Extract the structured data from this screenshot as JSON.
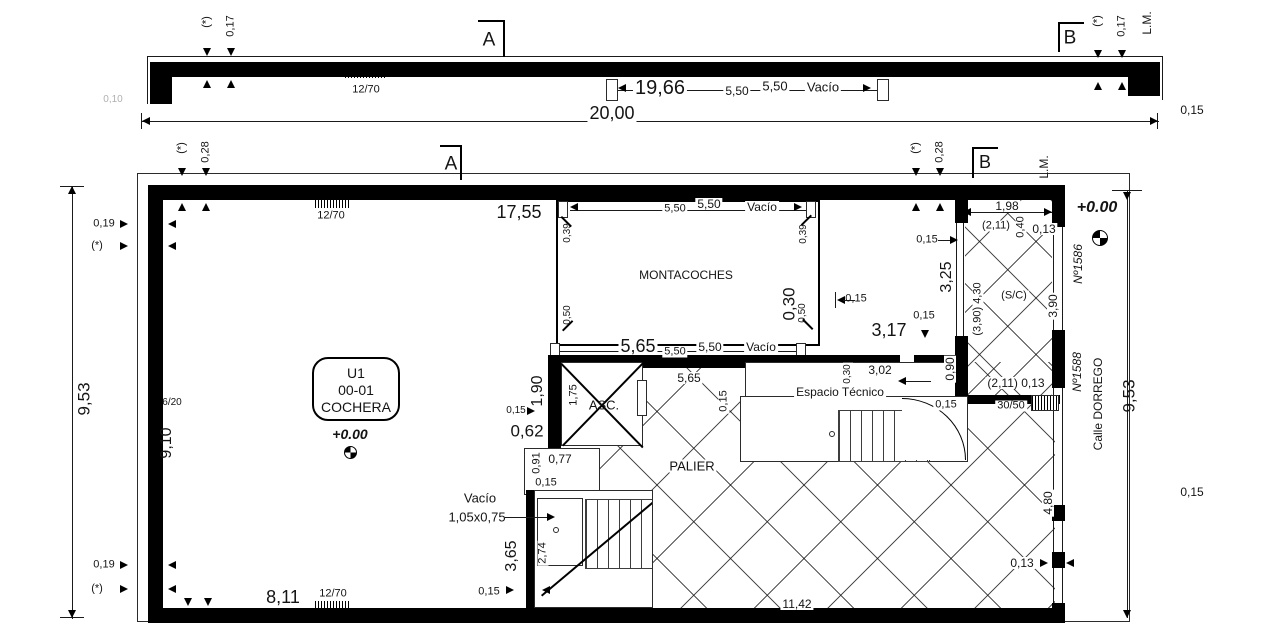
{
  "drawing": {
    "type": "architectural-floor-plan",
    "unit_label": "U1 00-01 COCHERA",
    "street": "Calle DORREGO",
    "colors": {
      "ink": "#141414",
      "wall": "#000000",
      "paper": "#ffffff",
      "faint": "#b0b0b0"
    }
  },
  "labels": [
    {
      "id": "star-top-left",
      "t": "(*)",
      "x": 207,
      "y": 22,
      "r": -90
    },
    {
      "id": "dim-017-left",
      "t": "0,17",
      "x": 231,
      "y": 26,
      "r": -90
    },
    {
      "id": "hatch-1270-topstrip",
      "t": "12/70",
      "x": 366,
      "y": 90
    },
    {
      "id": "marker-a-topstrip",
      "t": "A",
      "x": 489,
      "y": 40,
      "s": 19
    },
    {
      "id": "dim-1966",
      "t": "19,66",
      "x": 660,
      "y": 88,
      "s": 20,
      "bg": 1
    },
    {
      "id": "dim-550a-topstrip",
      "t": "5,50",
      "x": 737,
      "y": 91,
      "s": 12,
      "bg": 1
    },
    {
      "id": "dim-550b-topstrip",
      "t": "5,50",
      "x": 775,
      "y": 86,
      "s": 13,
      "bg": 1
    },
    {
      "id": "vacio-topstrip",
      "t": "Vacío",
      "x": 823,
      "y": 87,
      "s": 13,
      "bg": 1
    },
    {
      "id": "marker-b-topstrip",
      "t": "B",
      "x": 1070,
      "y": 38,
      "s": 19
    },
    {
      "id": "star-top-right",
      "t": "(*)",
      "x": 1098,
      "y": 21,
      "r": -90
    },
    {
      "id": "dim-017-right",
      "t": "0,17",
      "x": 1122,
      "y": 26,
      "r": -90
    },
    {
      "id": "lm-topstrip",
      "t": "L.M.",
      "x": 1147,
      "y": 23,
      "r": -90,
      "s": 12
    },
    {
      "id": "dim-015-topright",
      "t": "0,15",
      "x": 1192,
      "y": 110,
      "s": 12
    },
    {
      "id": "dim-2000",
      "t": "20,00",
      "x": 612,
      "y": 113,
      "s": 18,
      "bg": 1
    },
    {
      "id": "faint-010",
      "t": "0,10",
      "x": 113,
      "y": 100,
      "s": 10,
      "c": "#b0b0b0"
    },
    {
      "id": "star-main-left",
      "t": "(*)",
      "x": 182,
      "y": 148,
      "r": -90
    },
    {
      "id": "dim-028-left",
      "t": "0,28",
      "x": 206,
      "y": 152,
      "r": -90
    },
    {
      "id": "marker-a-main",
      "t": "A",
      "x": 451,
      "y": 164,
      "s": 19
    },
    {
      "id": "hatch-1270-main",
      "t": "12/70",
      "x": 331,
      "y": 216
    },
    {
      "id": "dim-1755",
      "t": "17,55",
      "x": 519,
      "y": 212,
      "s": 18
    },
    {
      "id": "dim-550a-mont-top",
      "t": "5,50",
      "x": 675,
      "y": 209,
      "bg": 1
    },
    {
      "id": "dim-550b-mont-top",
      "t": "5,50",
      "x": 709,
      "y": 204,
      "s": 12,
      "bg": 1
    },
    {
      "id": "vacio-mont-top",
      "t": "Vacío",
      "x": 762,
      "y": 207,
      "s": 12,
      "bg": 1
    },
    {
      "id": "star-main-right",
      "t": "(*)",
      "x": 916,
      "y": 148,
      "r": -90
    },
    {
      "id": "dim-028-right",
      "t": "0,28",
      "x": 940,
      "y": 152,
      "r": -90
    },
    {
      "id": "marker-b-main",
      "t": "B",
      "x": 985,
      "y": 162,
      "s": 18
    },
    {
      "id": "lm-main",
      "t": "L.M.",
      "x": 1044,
      "y": 167,
      "r": -90,
      "s": 12
    },
    {
      "id": "dim-198",
      "t": "1,98",
      "x": 1007,
      "y": 206,
      "s": 12,
      "bg": 1
    },
    {
      "id": "dim-211-top",
      "t": "(2,11)",
      "x": 996,
      "y": 226,
      "bg": 1
    },
    {
      "id": "dim-040",
      "t": "0,40",
      "x": 1021,
      "y": 227,
      "r": -90,
      "bg": 1
    },
    {
      "id": "dim-013-top",
      "t": "0,13",
      "x": 1044,
      "y": 229,
      "s": 12,
      "bg": 1
    },
    {
      "id": "level-main",
      "t": "+0.00",
      "x": 1097,
      "y": 208,
      "s": 16,
      "i": 1,
      "b": 1
    },
    {
      "id": "no-1586",
      "t": "Nº1586",
      "x": 1078,
      "y": 264,
      "r": -90,
      "s": 12,
      "i": 1
    },
    {
      "id": "dim-015-entry-top",
      "t": "0,15",
      "x": 927,
      "y": 240
    },
    {
      "id": "dim-325",
      "t": "3,25",
      "x": 947,
      "y": 277,
      "r": -90,
      "s": 16
    },
    {
      "id": "dim-390-430",
      "t": "(3,90) 4,30",
      "x": 978,
      "y": 309,
      "r": -90,
      "bg": 1
    },
    {
      "id": "sc-label",
      "t": "(S/C)",
      "x": 1014,
      "y": 296,
      "bg": 1
    },
    {
      "id": "dim-390-right",
      "t": "3,90",
      "x": 1053,
      "y": 306,
      "r": -90,
      "s": 12,
      "bg": 1
    },
    {
      "id": "dim-015-entry-mid",
      "t": "0,15",
      "x": 924,
      "y": 316,
      "bg": 1
    },
    {
      "id": "dim-090",
      "t": "0,90",
      "x": 950,
      "y": 369,
      "r": -90,
      "s": 12,
      "bg": 1
    },
    {
      "id": "dim-211-bottom",
      "t": "(2,11) 0,13",
      "x": 1016,
      "y": 383,
      "s": 12,
      "bg": 1
    },
    {
      "id": "hatch-3050",
      "t": "30/50",
      "x": 1011,
      "y": 406,
      "bg": 1
    },
    {
      "id": "no-1588",
      "t": "Nº1588",
      "x": 1077,
      "y": 372,
      "r": -90,
      "s": 12,
      "i": 1
    },
    {
      "id": "calle-dorrego",
      "t": "Calle DORREGO",
      "x": 1098,
      "y": 404,
      "r": -90,
      "s": 12
    },
    {
      "id": "dim-953-right",
      "t": "9,53",
      "x": 1129,
      "y": 396,
      "r": -90,
      "s": 17
    },
    {
      "id": "dim-015-right",
      "t": "0,15",
      "x": 1192,
      "y": 492,
      "s": 12
    },
    {
      "id": "dim-480",
      "t": "4,80",
      "x": 1048,
      "y": 503,
      "r": -90,
      "s": 12,
      "bg": 1
    },
    {
      "id": "dim-013-bottom",
      "t": "0,13",
      "x": 1022,
      "y": 563,
      "s": 12,
      "bg": 1
    },
    {
      "id": "dim-039-left",
      "t": "0,39",
      "x": 568,
      "y": 233,
      "r": -90,
      "s": 10
    },
    {
      "id": "dim-039-right",
      "t": "0,39",
      "x": 804,
      "y": 234,
      "r": -90,
      "s": 10
    },
    {
      "id": "montacoches",
      "t": "MONTACOCHES",
      "x": 686,
      "y": 275,
      "s": 12
    },
    {
      "id": "dim-050-left",
      "t": "0,50",
      "x": 568,
      "y": 315,
      "r": -90,
      "s": 10
    },
    {
      "id": "dim-030-big",
      "t": "0,30",
      "x": 789,
      "y": 304,
      "r": -90,
      "s": 17
    },
    {
      "id": "dim-050-right",
      "t": "0,50",
      "x": 803,
      "y": 313,
      "r": -90,
      "s": 10
    },
    {
      "id": "dim-015-mont",
      "t": "0,15",
      "x": 856,
      "y": 299
    },
    {
      "id": "dim-565-big",
      "t": "5,65",
      "x": 638,
      "y": 346,
      "s": 18,
      "bg": 1
    },
    {
      "id": "dim-550a-mont-bot",
      "t": "5,50",
      "x": 675,
      "y": 352,
      "bg": 1
    },
    {
      "id": "dim-550b-mont-bot",
      "t": "5,50",
      "x": 710,
      "y": 347,
      "s": 12,
      "bg": 1
    },
    {
      "id": "vacio-mont-bot",
      "t": "Vacío",
      "x": 761,
      "y": 347,
      "s": 12,
      "bg": 1
    },
    {
      "id": "dim-317",
      "t": "3,17",
      "x": 889,
      "y": 330,
      "s": 18
    },
    {
      "id": "dim-190",
      "t": "1,90",
      "x": 538,
      "y": 391,
      "r": -90,
      "s": 16
    },
    {
      "id": "dim-175",
      "t": "1,75",
      "x": 574,
      "y": 395,
      "r": -90
    },
    {
      "id": "asc",
      "t": "ASC.",
      "x": 604,
      "y": 405,
      "s": 13
    },
    {
      "id": "dim-565-palier",
      "t": "5,65",
      "x": 689,
      "y": 378,
      "s": 12,
      "bg": 1
    },
    {
      "id": "dim-015-asc-side",
      "t": "0,15",
      "x": 724,
      "y": 401,
      "r": -90,
      "bg": 1
    },
    {
      "id": "dim-015-left-asc",
      "t": "0,15",
      "x": 516,
      "y": 411,
      "s": 10
    },
    {
      "id": "dim-062",
      "t": "0,62",
      "x": 527,
      "y": 431,
      "s": 17
    },
    {
      "id": "dim-091",
      "t": "0,91",
      "x": 537,
      "y": 463,
      "r": -90
    },
    {
      "id": "dim-077",
      "t": "0,77",
      "x": 560,
      "y": 459,
      "s": 12
    },
    {
      "id": "dim-015-shaft",
      "t": "0,15",
      "x": 546,
      "y": 483
    },
    {
      "id": "palier",
      "t": "PALIER",
      "x": 692,
      "y": 466,
      "s": 13,
      "bg": 1
    },
    {
      "id": "espacio-tecnico",
      "t": "Espacio Técnico",
      "x": 840,
      "y": 392,
      "s": 12,
      "bg": 1
    },
    {
      "id": "dim-302",
      "t": "3,02",
      "x": 880,
      "y": 370,
      "s": 12,
      "bg": 1
    },
    {
      "id": "dim-030-esp",
      "t": "0,30",
      "x": 848,
      "y": 374,
      "r": -90,
      "s": 10,
      "bg": 1
    },
    {
      "id": "dim-015-esp",
      "t": "0,15",
      "x": 946,
      "y": 405,
      "bg": 1
    },
    {
      "id": "unit-code",
      "t": "U1",
      "x": 356,
      "y": 373,
      "s": 14
    },
    {
      "id": "unit-number",
      "t": "00-01",
      "x": 356,
      "y": 390,
      "s": 14
    },
    {
      "id": "unit-name",
      "t": "COCHERA",
      "x": 356,
      "y": 407,
      "s": 14
    },
    {
      "id": "level-cochera",
      "t": "+0.00",
      "x": 350,
      "y": 434,
      "s": 14,
      "i": 1,
      "b": 1
    },
    {
      "id": "vacio-void",
      "t": "Vacío",
      "x": 480,
      "y": 498,
      "s": 13
    },
    {
      "id": "void-size",
      "t": "1,05x0,75",
      "x": 477,
      "y": 517,
      "s": 13
    },
    {
      "id": "dim-365",
      "t": "3,65",
      "x": 512,
      "y": 556,
      "r": -90,
      "s": 16
    },
    {
      "id": "dim-274",
      "t": "2,74",
      "x": 543,
      "y": 553,
      "r": -90,
      "bg": 1
    },
    {
      "id": "dim-015-void",
      "t": "0,15",
      "x": 489,
      "y": 592
    },
    {
      "id": "dim-019-top",
      "t": "0,19",
      "x": 104,
      "y": 224
    },
    {
      "id": "star-left-top",
      "t": "(*)",
      "x": 97,
      "y": 246
    },
    {
      "id": "dim-953-left",
      "t": "9,53",
      "x": 84,
      "y": 399,
      "r": -90,
      "s": 17
    },
    {
      "id": "hatch-620",
      "t": "6/20",
      "x": 172,
      "y": 403,
      "s": 10
    },
    {
      "id": "dim-910",
      "t": "9,10",
      "x": 167,
      "y": 443,
      "r": -90,
      "s": 16
    },
    {
      "id": "dim-019-bottom",
      "t": "0,19",
      "x": 104,
      "y": 565
    },
    {
      "id": "star-left-bottom",
      "t": "(*)",
      "x": 97,
      "y": 589
    },
    {
      "id": "dim-811",
      "t": "8,11",
      "x": 283,
      "y": 597,
      "s": 18
    },
    {
      "id": "hatch-1270-bottom",
      "t": "12/70",
      "x": 333,
      "y": 594
    },
    {
      "id": "dim-1142",
      "t": "11,42",
      "x": 797,
      "y": 604,
      "s": 12,
      "bg": 1
    }
  ]
}
